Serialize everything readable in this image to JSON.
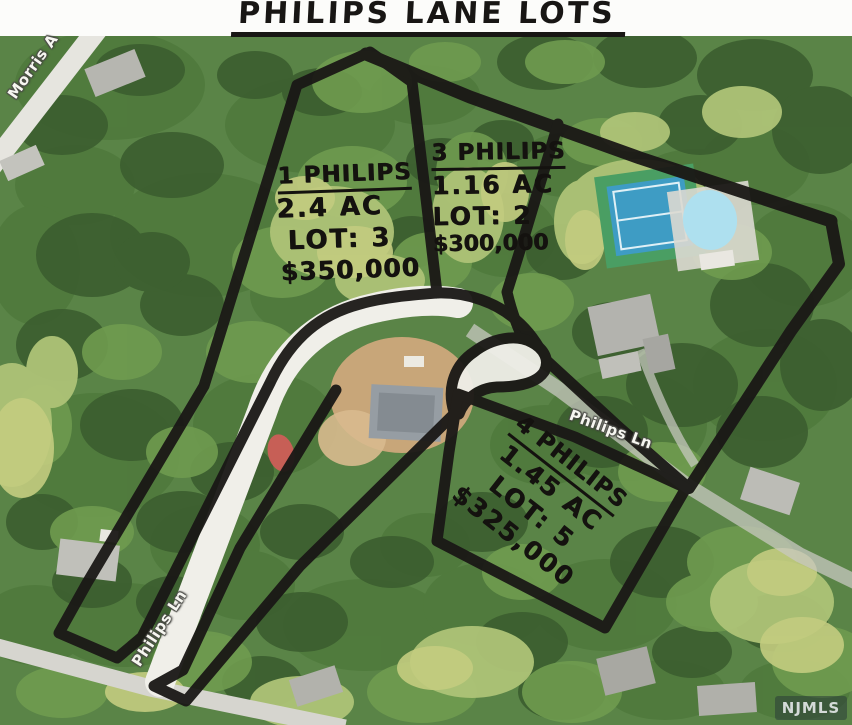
{
  "title": "PHILIPS LANE LOTS",
  "map": {
    "lots": [
      {
        "id": "lot-1",
        "name": "1 PHILIPS",
        "acreage": "2.4 AC",
        "lot_number": "LOT: 3",
        "price": "$350,000"
      },
      {
        "id": "lot-3",
        "name": "3 PHILIPS",
        "acreage": "1.16 AC",
        "lot_number": "LOT: 2",
        "price": "$300,000"
      },
      {
        "id": "lot-4",
        "name": "4 PHILIPS",
        "acreage": "1.45 AC",
        "lot_number": "LOT: 5",
        "price": "$325,000"
      }
    ],
    "street_labels": {
      "morris_avenue": "Morris A",
      "philips_lane_upper": "Philips Ln",
      "philips_lane_lower": "Philips Ln"
    }
  },
  "watermark": "NJMLS",
  "colors": {
    "marker_ink": "#1a1816",
    "road_pavement": "#f0efe9",
    "tennis_court_blue": "#3e9cc4",
    "tennis_surround_green": "#4a9e63",
    "pool_blue": "#aee0ef",
    "red_marker_dot": "#e2595b",
    "aerial_base_green": "#5a8447"
  }
}
